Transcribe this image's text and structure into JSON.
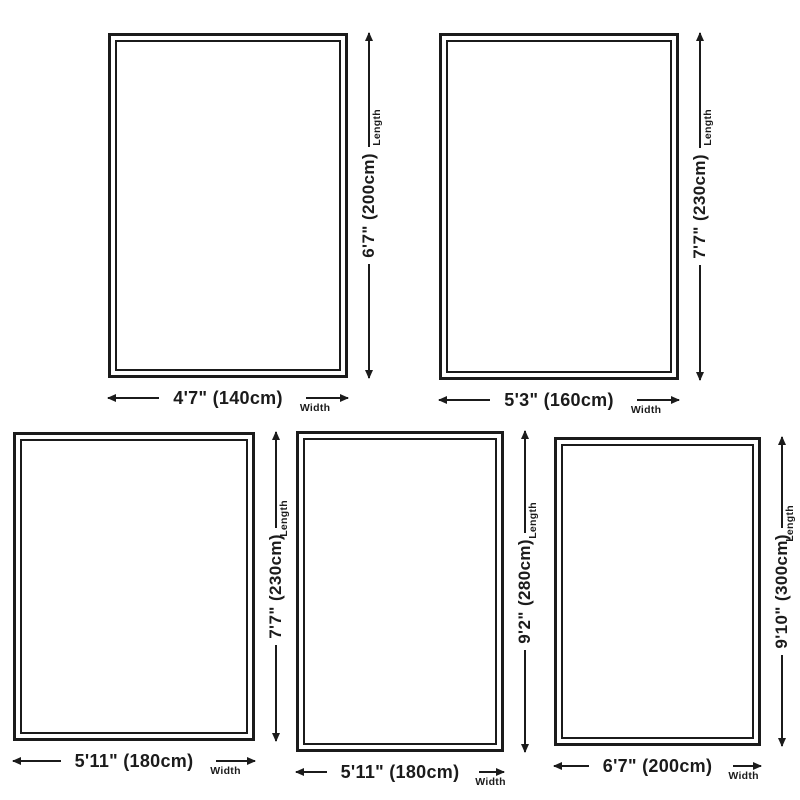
{
  "diagram": {
    "background": "#ffffff",
    "ink_color": "#1b1b1b",
    "length_label": "Length",
    "width_label": "Width"
  },
  "rugs": [
    {
      "name": "rug-size-1",
      "width": "4'7\" (140cm)",
      "length": "6'7\" (200cm)"
    },
    {
      "name": "rug-size-2",
      "width": "5'3\" (160cm)",
      "length": "7'7\" (230cm)"
    },
    {
      "name": "rug-size-3",
      "width": "5'11\" (180cm)",
      "length": "7'7\" (230cm)"
    },
    {
      "name": "rug-size-4",
      "width": "5'11\" (180cm)",
      "length": "9'2\" (280cm)"
    },
    {
      "name": "rug-size-5",
      "width": "6'7\" (200cm)",
      "length": "9'10\" (300cm)"
    }
  ]
}
